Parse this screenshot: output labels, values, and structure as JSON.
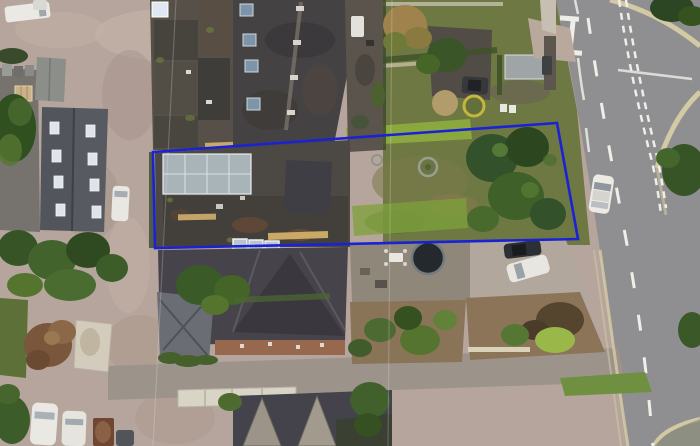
{
  "scene": {
    "kind": "aerial-satellite-photo",
    "description": "Overhead aerial photograph of a residential block: terraced buildings and rear yards in the centre, an access lane and outbuildings on the left, rear gardens with trees on the right, a main road with junction on the right edge and a minor road across the bottom. A blue quadrilateral annotation outlines a long plot.",
    "annotation": {
      "name": "site-boundary",
      "shape": "quadrilateral",
      "points": "153,152 557,123 578,239 155,248",
      "color": "#1a22d4",
      "stroke_width": 2.6
    },
    "palette": {
      "ground_dirt": "#b6a59c",
      "tarmac_dark": "#76726e",
      "road_asphalt": "#8f8f91",
      "minor_road": "#9c938b",
      "kerb_stone": "#d3c9a4",
      "road_marking": "#efeee8",
      "roof_dark": "#454244",
      "roof_slate": "#53555c",
      "lawn_olive": "#6e7843",
      "lawn_bright": "#8cab3e",
      "tree_dark": "#31491f",
      "boundary_blue": "#1a22d4"
    }
  }
}
